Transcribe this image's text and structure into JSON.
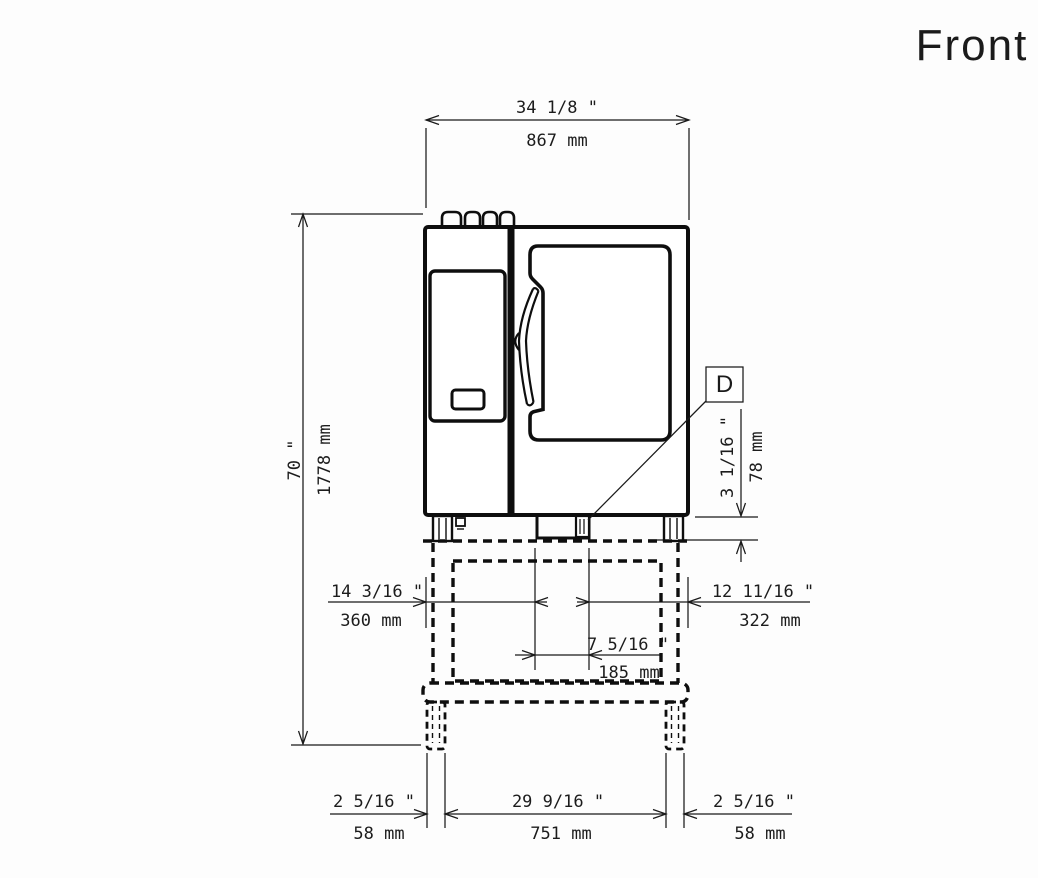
{
  "title": "Front",
  "labels": {
    "detail_d": "D"
  },
  "dims": {
    "width_top": {
      "in": "34 1/8 \"",
      "mm": "867 mm"
    },
    "height_left": {
      "in": "70 \"",
      "mm": "1778 mm"
    },
    "foot_height": {
      "in": "3 1/16 \"",
      "mm": "78 mm"
    },
    "offset_left": {
      "in": "14 3/16 \"",
      "mm": "360 mm"
    },
    "offset_right": {
      "in": "12 11/16 \"",
      "mm": "322 mm"
    },
    "drain_center": {
      "in": "7 5/16 \"",
      "mm": "185 mm"
    },
    "leg_left": {
      "in": "2 5/16 \"",
      "mm": "58 mm"
    },
    "leg_span": {
      "in": "29 9/16 \"",
      "mm": "751 mm"
    },
    "leg_right": {
      "in": "2 5/16 \"",
      "mm": "58 mm"
    }
  },
  "colors": {
    "line": "#1a1a1a",
    "drawing": "#0e0e0e",
    "background": "#fdfdfd"
  }
}
